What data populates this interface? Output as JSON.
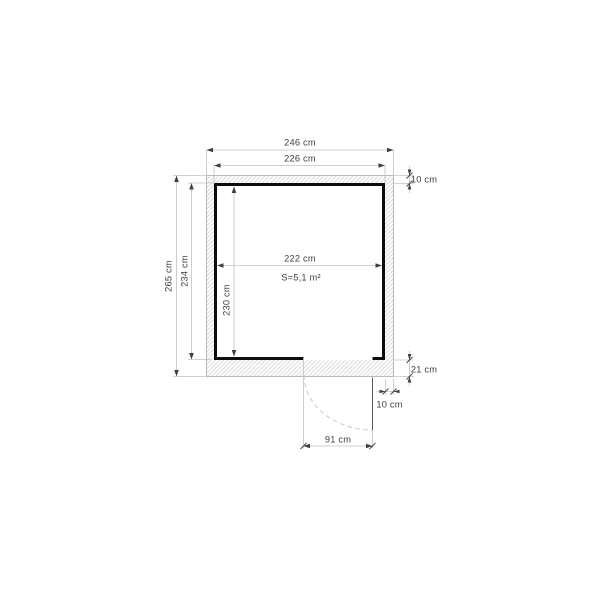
{
  "diagram": {
    "area_label": "S=5,1 m²",
    "dimensions": {
      "outer_width": "246 cm",
      "inner_width": "226 cm",
      "wall_thickness_top": "10 cm",
      "outer_depth": "265 cm",
      "inner_depth": "234 cm",
      "room_width": "222 cm",
      "room_depth": "230 cm",
      "bottom_wall_thickness": "21 cm",
      "wall_thickness_bottom_right": "10 cm",
      "door_width": "91 cm"
    },
    "colors": {
      "background": "#ffffff",
      "wall_hatch": "#cdcdcd",
      "wall_outline": "#b3b3b3",
      "wall_inner_line": "#0d0d0d",
      "dimension_line": "#c2c2c2",
      "arrow": "#3f3f3f",
      "text": "#3d3d3d",
      "door_swing": "#c9c9c9"
    }
  }
}
